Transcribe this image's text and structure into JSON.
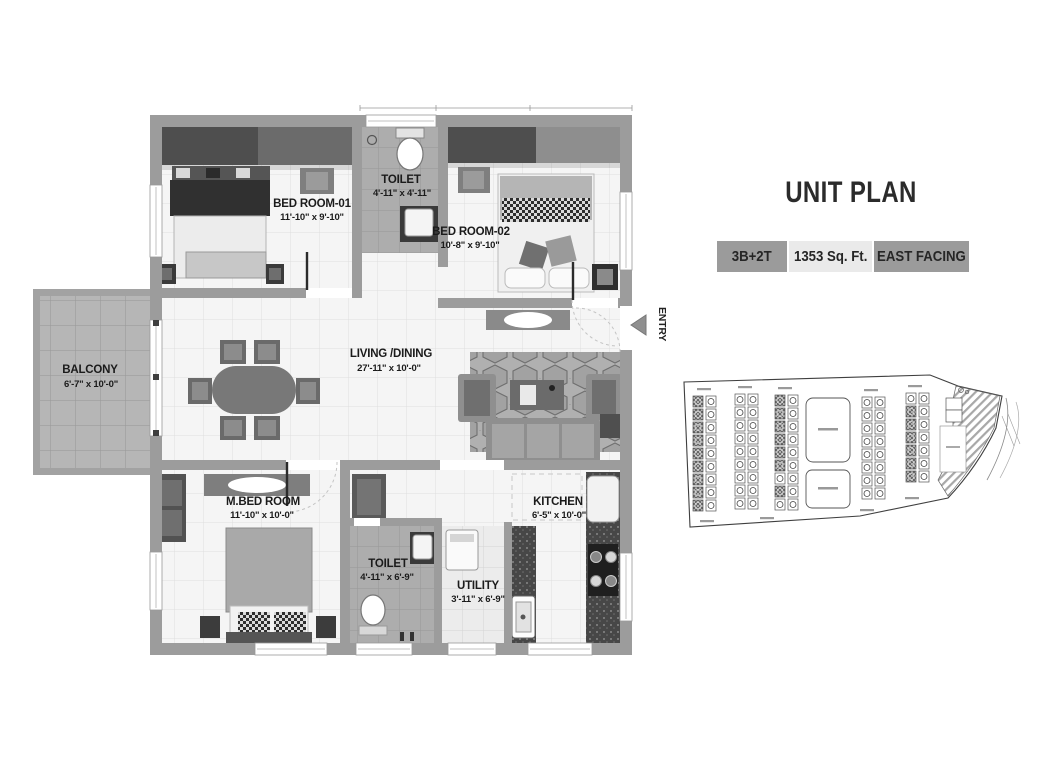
{
  "header": {
    "title": "UNIT PLAN"
  },
  "badges": [
    {
      "label": "3B+2T"
    },
    {
      "label": "1353 Sq. Ft."
    },
    {
      "label": "EAST FACING"
    }
  ],
  "entry": {
    "label": "ENTRY"
  },
  "rooms": [
    {
      "name": "BED ROOM-01",
      "dims": "11'-10\" x 9'-10\""
    },
    {
      "name": "TOILET",
      "dims": "4'-11\" x 4'-11\""
    },
    {
      "name": "BED ROOM-02",
      "dims": "10'-8\" x 9'-10\""
    },
    {
      "name": "BALCONY",
      "dims": "6'-7\" x 10'-0\""
    },
    {
      "name": "LIVING /DINING",
      "dims": "27'-11\" x 10'-0\""
    },
    {
      "name": "M.BED ROOM",
      "dims": "11'-10\" x 10'-0\""
    },
    {
      "name": "TOILET",
      "dims": "4'-11\" x 6'-9\""
    },
    {
      "name": "UTILITY",
      "dims": "3'-11\" x 6'-9\""
    },
    {
      "name": "KITCHEN",
      "dims": "6'-5\" x 10'-0\""
    }
  ],
  "colors": {
    "wall": "#9c9c9c",
    "badge_dark": "#9b9b9b",
    "badge_light": "#eaeaea",
    "text": "#1b1b1b"
  }
}
